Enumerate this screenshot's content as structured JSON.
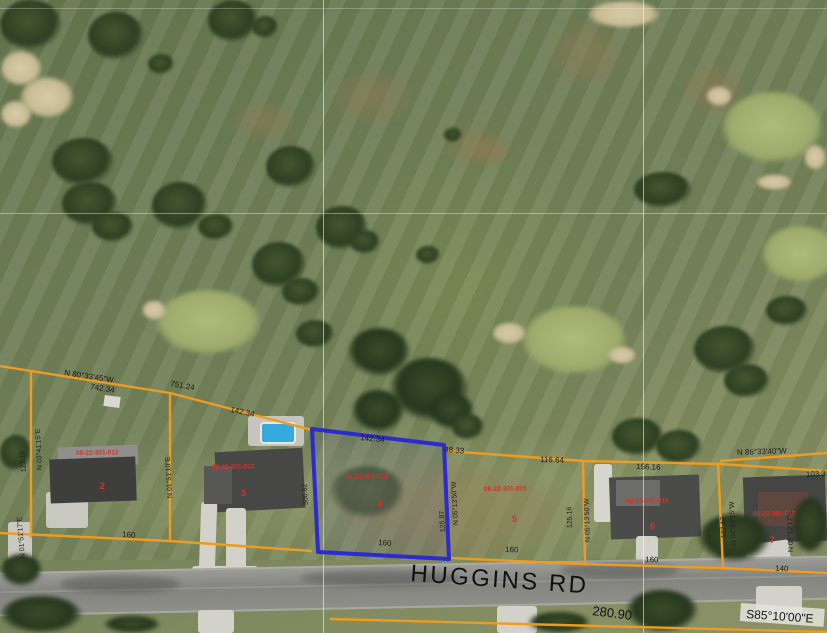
{
  "map": {
    "road_label": "HUGGINS RD",
    "colors": {
      "parcel_line": "#ED9C1E",
      "selected_parcel": "#2B2BD0",
      "grid_line": "#FFFFFF",
      "survey_text": "#1A1A1A",
      "parcel_text": "#D03428"
    }
  },
  "survey": {
    "nw_bearing": "N 80°33'45\"W",
    "nw_dist": "742.34",
    "nw_dist2": "751.24",
    "lot3_frontage_n": "142.34",
    "lot4_frontage_n": "142.34",
    "lot5_jog": "48.33",
    "lot5_frontage_n": "116.64",
    "lot6_frontage_n": "156.16",
    "ne_bearing": "N 86°33'40\"W",
    "ne_dist": "103.31",
    "w_line_bearing": "N 03°41'15\"E",
    "w_line_dist": "123.16",
    "w2_line_bearing": "N 01°51'10\"E",
    "sel_w_dist": "300.62",
    "sel_e_dist": "125.87",
    "sel_e_bearing": "N 05°13'50\"W",
    "e1_dist": "125.16",
    "e1_bearing": "N 05°13'50\"W",
    "e2_dist": "127.17",
    "e2_bearing": "N 04°51'15\"W",
    "e3_bearing": "N 05°12'17\"E",
    "sw_bearing": "N 01°51'17\"E",
    "front_lot2": "160",
    "front_lot4": "160",
    "front_lot5": "160",
    "front_lot6": "160",
    "front_lot7": "140",
    "s_dist": "280.90",
    "s_bearing": "S85°10'00\"E"
  },
  "parcels": [
    {
      "id": "08-22-301-012",
      "lot": "2"
    },
    {
      "id": "08-22-301-013",
      "lot": "3"
    },
    {
      "id": "08-22-301-014",
      "lot": "4"
    },
    {
      "id": "08-22-301-015",
      "lot": "5"
    },
    {
      "id": "08-22-301-016",
      "lot": "6"
    },
    {
      "id": "08-22-301-017",
      "lot": "7"
    }
  ]
}
